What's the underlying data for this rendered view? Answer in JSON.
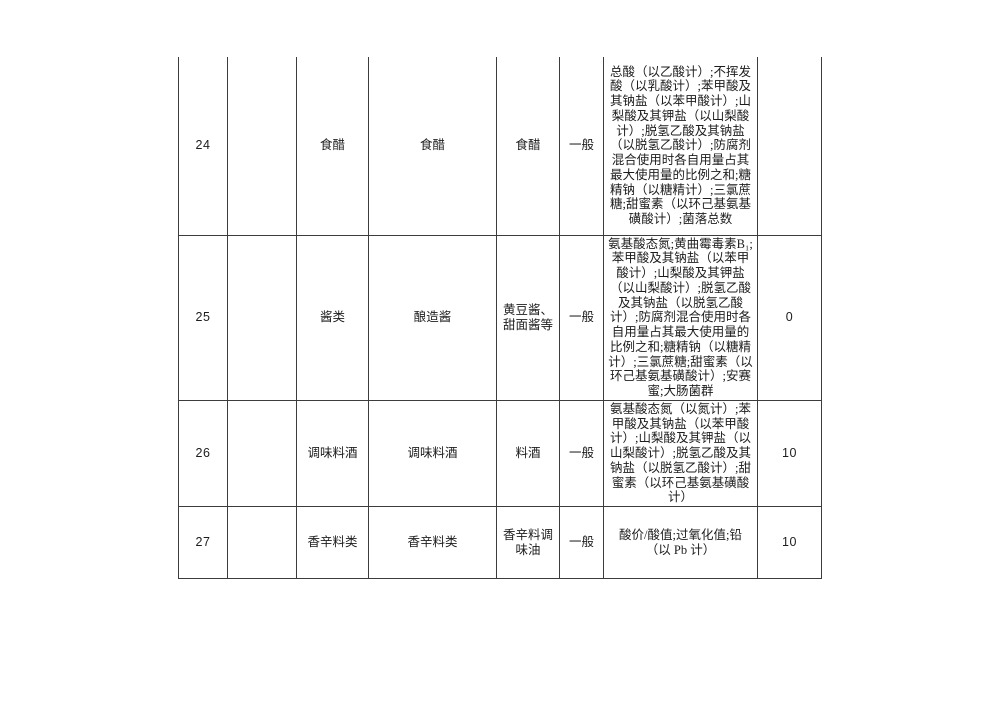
{
  "document": {
    "background": "#ffffff",
    "table_border_color": "#3c3c3c",
    "table": {
      "rows": [
        {
          "no": "24",
          "group": "",
          "category": "食醋",
          "subcategory": "食醋",
          "item": "食醋",
          "sample_type": "一般",
          "test_items": "总酸（以乙酸计）;不挥发酸（以乳酸计）;苯甲酸及其钠盐（以苯甲酸计）;山梨酸及其钾盐（以山梨酸计）;脱氢乙酸及其钠盐（以脱氢乙酸计）;防腐剂混合使用时各自用量占其最大使用量的比例之和;糖精钠（以糖精计）;三氯蔗糖;甜蜜素（以环己基氨基磺酸计）;菌落总数",
          "value": ""
        },
        {
          "no": "25",
          "group": "",
          "category": "酱类",
          "subcategory": "酿造酱",
          "item": "黄豆酱、甜面酱等",
          "sample_type": "一般",
          "test_items": "氨基酸态氮;黄曲霉毒素B₁;苯甲酸及其钠盐（以苯甲酸计）;山梨酸及其钾盐（以山梨酸计）;脱氢乙酸及其钠盐（以脱氢乙酸计）;防腐剂混合使用时各自用量占其最大使用量的比例之和;糖精钠（以糖精计）;三氯蔗糖;甜蜜素（以环己基氨基磺酸计）;安赛蜜;大肠菌群",
          "value": "0"
        },
        {
          "no": "26",
          "group": "",
          "category": "调味料酒",
          "subcategory": "调味料酒",
          "item": "料酒",
          "sample_type": "一般",
          "test_items": "氨基酸态氮（以氮计）;苯甲酸及其钠盐（以苯甲酸计）;山梨酸及其钾盐（以山梨酸计）;脱氢乙酸及其钠盐（以脱氢乙酸计）;甜蜜素（以环己基氨基磺酸计）",
          "value": "10"
        },
        {
          "no": "27",
          "group": "",
          "category": "香辛料类",
          "subcategory": "香辛料类",
          "item": "香辛料调味油",
          "sample_type": "一般",
          "test_items": "酸价/酸值;过氧化值;铅（以 Pb 计）",
          "value": "10"
        }
      ]
    }
  }
}
